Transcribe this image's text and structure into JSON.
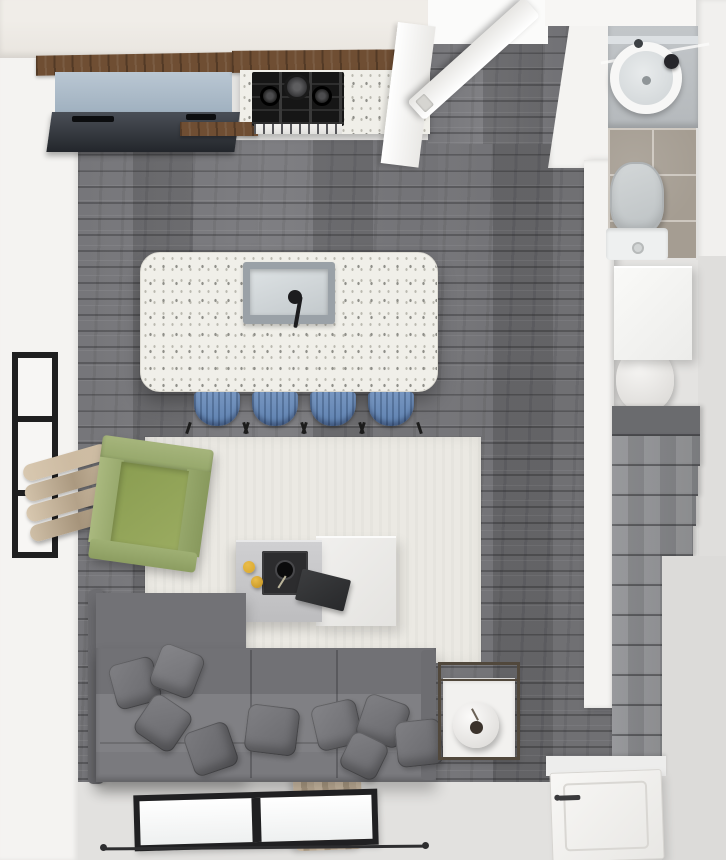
{
  "scene": {
    "title": "Top-down 3D render of a studio apartment",
    "view": "top-down floor plan",
    "rooms": [
      {
        "name": "Kitchen",
        "items": [
          "refrigerator counter",
          "gas cooktop",
          "speckled quartz counter",
          "kitchen island with sink",
          "faucet",
          "bar stool"
        ]
      },
      {
        "name": "Living room",
        "items": [
          "area rug",
          "green armchair",
          "gray sectional sofa",
          "throw pillow",
          "coffee table",
          "decor tray",
          "fruit",
          "book",
          "side table",
          "round vase",
          "window",
          "curtain"
        ]
      },
      {
        "name": "Bathroom",
        "items": [
          "vanity counter",
          "round basin sink",
          "glass shelf",
          "tile floor",
          "toilet"
        ]
      },
      {
        "name": "Hall and entry",
        "items": [
          "open interior door",
          "doorway opening",
          "closet cabinet",
          "water heater",
          "staircase",
          "entry door",
          "door handle"
        ]
      }
    ]
  },
  "palette": {
    "wood_floor": "#747478",
    "floor_light": "#e4e3e1",
    "wall_white": "#f4f3f1",
    "wall_cream": "#e9e5df",
    "rug": "#ebe9e3",
    "quartz": "#f0efe9",
    "speckle_dark": "#8f8f89",
    "wood_trim": "#6f4e33",
    "stool_blue": "#5d80af",
    "sofa_gray": "#7b7b7f",
    "pillow_gray": "#68686c",
    "chair_green": "#9aab60",
    "curtain_beige": "#cdbba2",
    "tile_taupe": "#a59d92",
    "stove_black": "#161616",
    "fruit_yellow": "#d9a62b",
    "frame_black": "#1f1f20",
    "fixture_gray": "#b5b9bc",
    "metal_bronze": "#51483c"
  }
}
